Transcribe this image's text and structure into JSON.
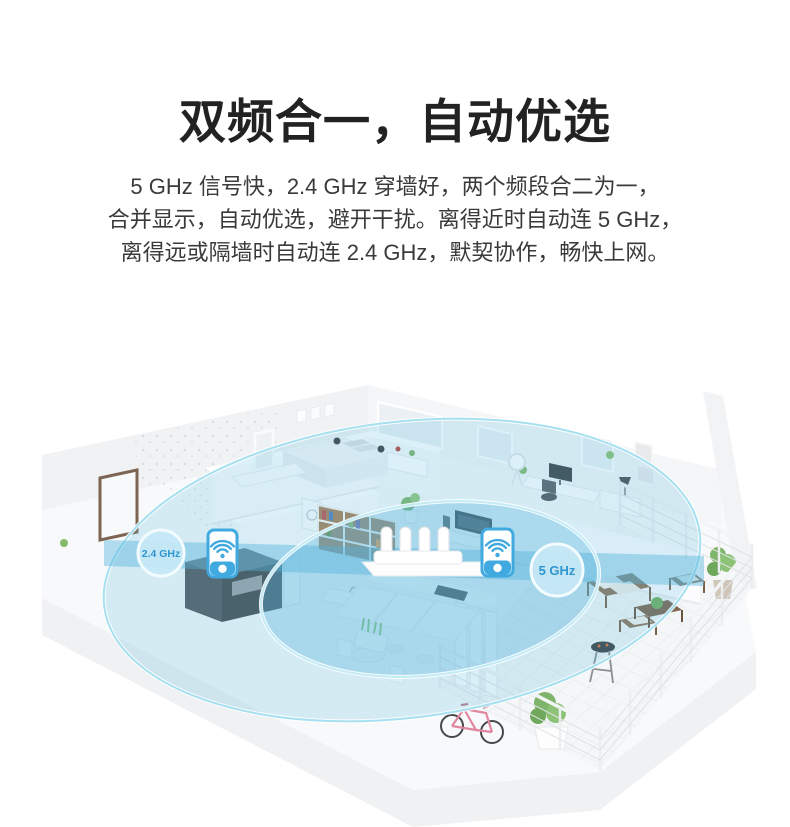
{
  "header": {
    "title": "双频合一，自动优选"
  },
  "intro": {
    "lines": [
      "5 GHz 信号快，2.4 GHz 穿墙好，两个频段合二为一，",
      "合并显示，自动优选，避开干扰。离得近时自动连 5 GHz，",
      "离得远或隔墙时自动连 2.4 GHz，默契协作，畅快上网。"
    ]
  },
  "illustration": {
    "scene": "isometric apartment cutaway showing dual-band Wi-Fi coverage",
    "labels": {
      "band_24": "2.4 GHz",
      "band_5": "5 GHz"
    },
    "icons": {
      "left_phone": "smartphone-wifi-icon",
      "right_phone": "smartphone-wifi-icon",
      "router": "router-four-antenna-icon"
    },
    "colors": {
      "coverage_fill": "#5ab9de",
      "coverage_ring": "#a6e0f0",
      "beam_fill": "#50b2dc",
      "phone_blue": "#3fa9e0",
      "label_text_blue": "#2e96cf"
    }
  }
}
